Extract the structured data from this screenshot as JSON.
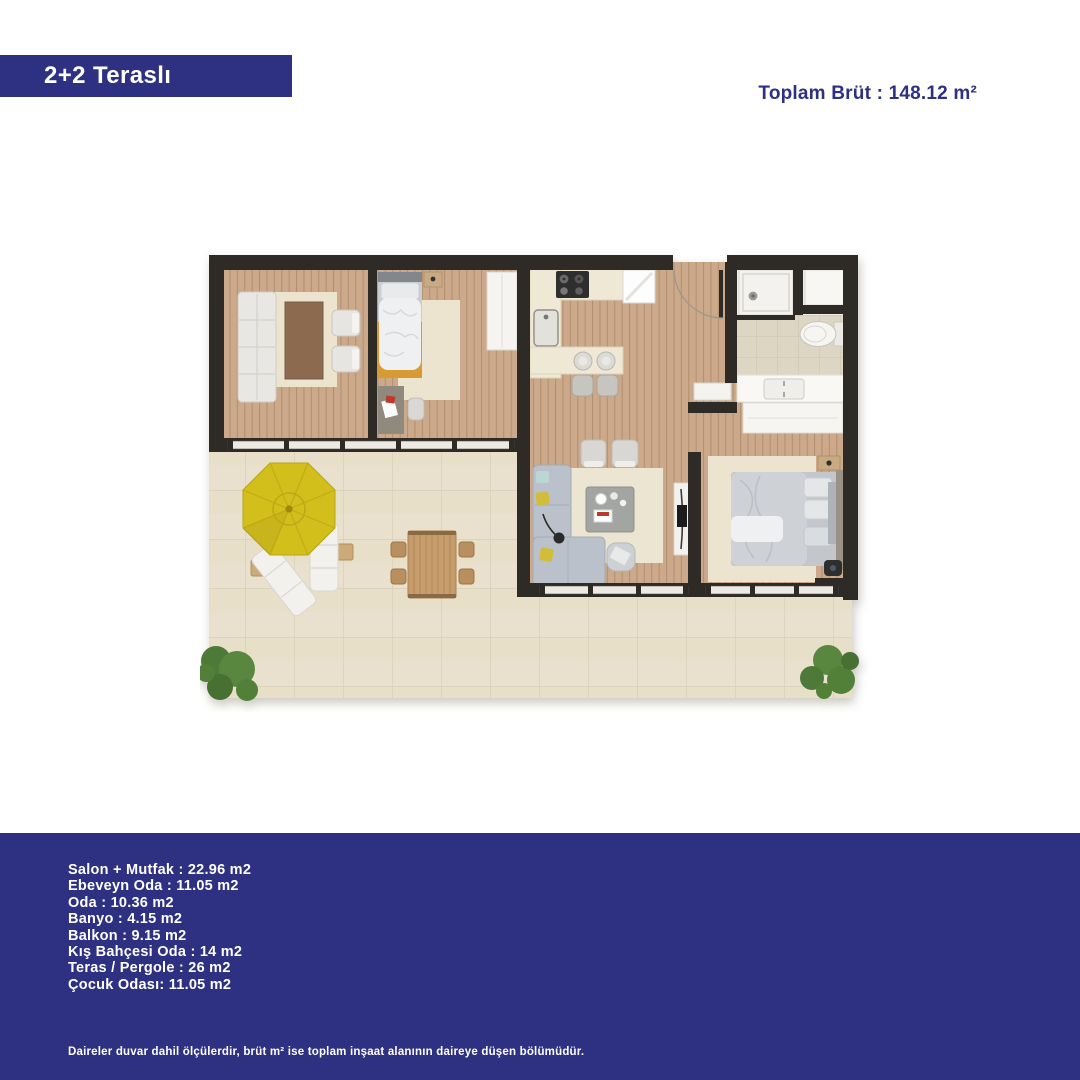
{
  "header": {
    "unit_type": "2+2 Teraslı",
    "total_gross": "Toplam Brüt : 148.12 m²"
  },
  "footer": {
    "rooms": [
      "Salon + Mutfak : 22.96 m2",
      "Ebeveyn Oda : 11.05 m2",
      "Oda : 10.36 m2",
      "Banyo : 4.15 m2",
      "Balkon : 9.15 m2",
      "Kış Bahçesi Oda : 14 m2",
      "Teras / Pergole : 26 m2",
      "Çocuk Odası: 11.05 m2"
    ],
    "disclaimer": "Daireler duvar dahil ölçülerdir, brüt m² ise toplam inşaat alanının daireye düşen bölümüdür."
  },
  "colors": {
    "accent_blue": "#2e3082",
    "wall_dark": "#2e2a27",
    "wood_floor": "#cba98a",
    "terrace_tile": "#e9e1cd",
    "bathroom_tile": "#ddd6c2",
    "umbrella_yellow": "#d3bf1d",
    "rug_cream": "#ece4cf",
    "greenery": "#54823b"
  }
}
